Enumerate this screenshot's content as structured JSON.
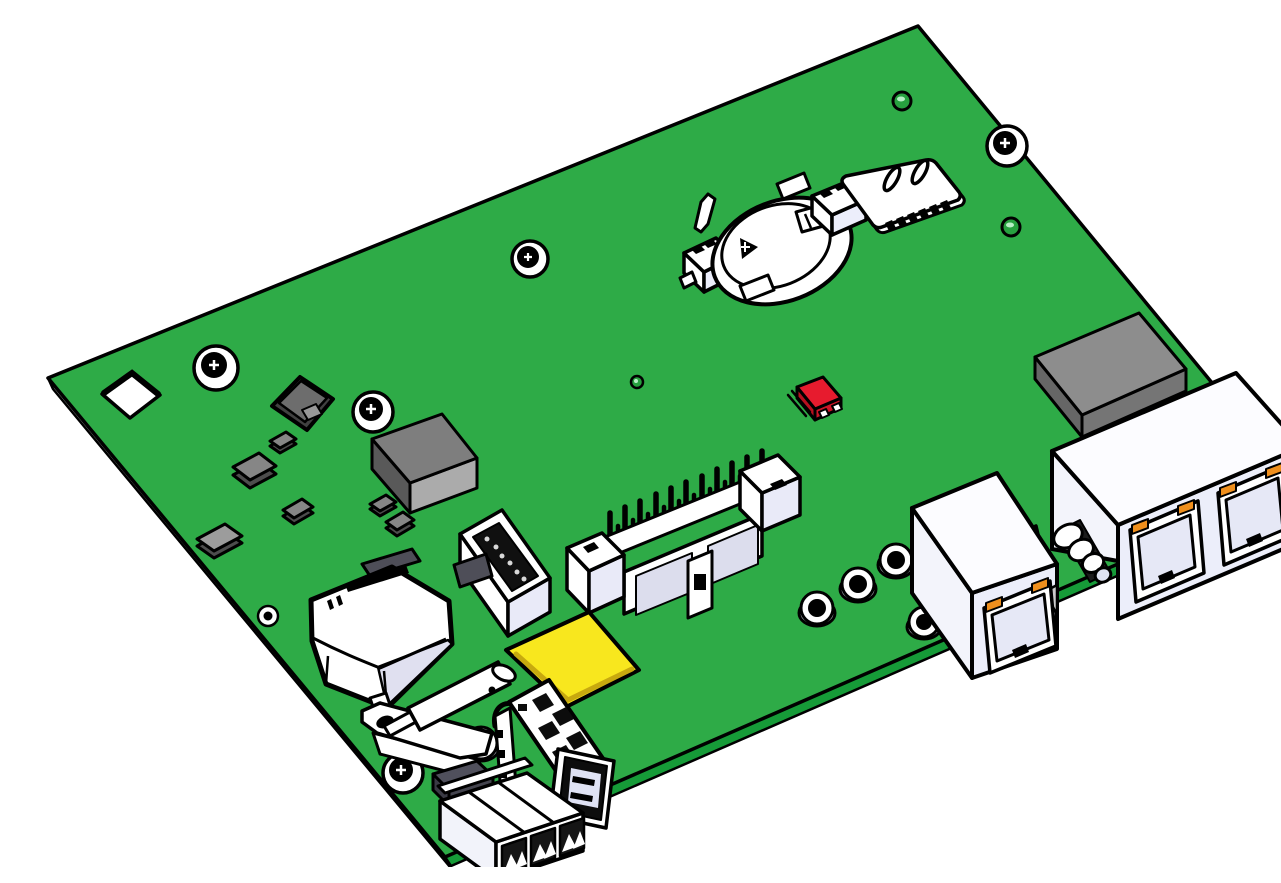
{
  "scene": {
    "type": "3d-cad-isometric-render",
    "subject": "Printed circuit board assembly",
    "background_color": "#ffffff",
    "outline_color": "#000000"
  },
  "board": {
    "label": "Green printed circuit board, isometric view",
    "top_color": "#2eab47",
    "edge_strip_color": "#169b38",
    "side_color": "#e9e9e9"
  },
  "palette": {
    "white_plastic": "#ffffff",
    "lavender_face": "#e9eaf8",
    "lavender_inner": "#e6e8f6",
    "gray_chip_top": "#868686",
    "gray_chip_side": "#4d4d4d",
    "module_gray": "#8d8d8d",
    "inductor_dark": "#414141",
    "red_component": "#e71b2e",
    "yellow_pad": "#f8e71e",
    "orange_led": "#ef8f1d",
    "black": "#000000"
  },
  "components": [
    {
      "label": "PCB board"
    },
    {
      "label": "Square corner cutout hole"
    },
    {
      "label": "Mounting screw hole"
    },
    {
      "label": "Plated through-hole"
    },
    {
      "label": "Via"
    },
    {
      "label": "Power inductor",
      "color": "#414141"
    },
    {
      "label": "SMD chip",
      "color": "#868686"
    },
    {
      "label": "IC chip",
      "color": "#7e7e7e"
    },
    {
      "label": "RF shield module",
      "color": "#8d8d8d"
    },
    {
      "label": "Red tact switch",
      "color": "#e71b2e"
    },
    {
      "label": "Coin cell battery holder",
      "color": "#ffffff"
    },
    {
      "label": "SIM card holder",
      "color": "#ffffff"
    },
    {
      "label": "Boxed IDC pin header",
      "color": "#ffffff"
    },
    {
      "label": "Vertical pin socket with black face",
      "color": "#101010"
    },
    {
      "label": "Yellow chip pad",
      "color": "#f8e71e"
    },
    {
      "label": "Relay with printed marking",
      "color": "#ffffff"
    },
    {
      "label": "Cylindrical fuse",
      "color": "#ffffff"
    },
    {
      "label": "Metal bracket",
      "color": "#ffffff"
    },
    {
      "label": "Jumper wire",
      "color": "#000000"
    },
    {
      "label": "USB-A connector",
      "color": "#ffffff"
    },
    {
      "label": "3-position terminal block",
      "color": "#ffffff"
    },
    {
      "label": "Single RJ45 jack with LEDs",
      "color": "#ffffff"
    },
    {
      "label": "Dual RJ45 jack with LEDs",
      "color": "#ffffff"
    },
    {
      "label": "Coax barrel connector",
      "color": "#ffffff"
    }
  ]
}
